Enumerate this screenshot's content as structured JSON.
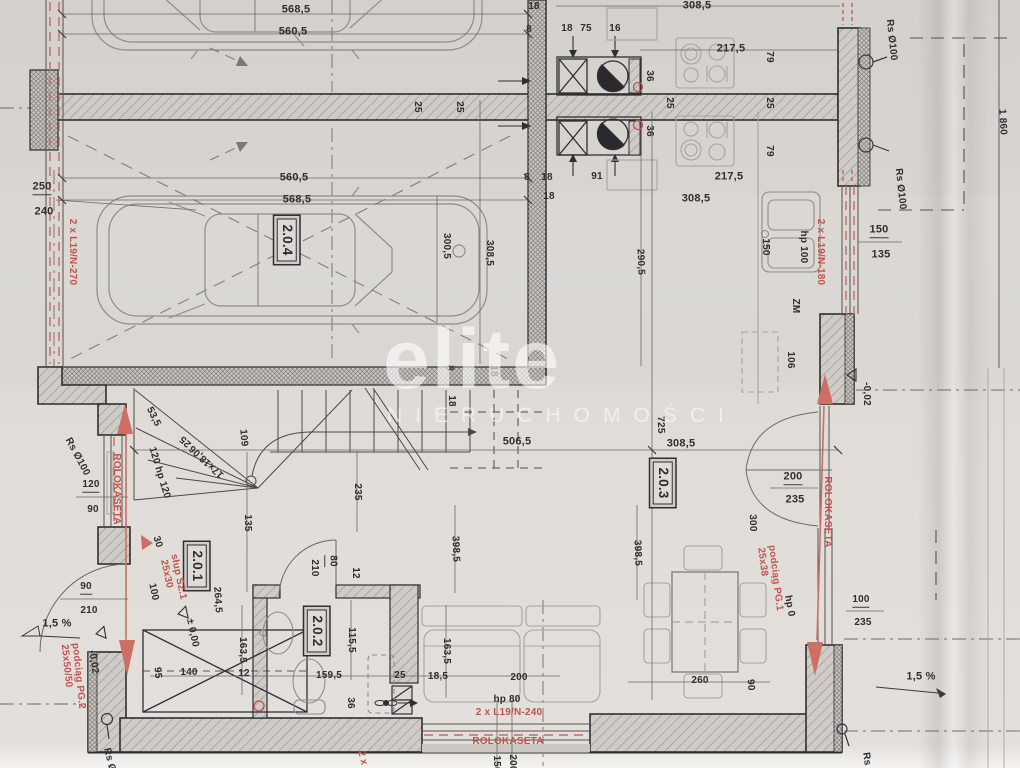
{
  "watermark": {
    "brand": "elite",
    "subtitle": "NIERUCHOMOŚCI"
  },
  "colors": {
    "paper": "#d9d6d2",
    "ink": "#3a393b",
    "light_gray": "#a9a7a3",
    "hatch": "#8e8c88",
    "red": "#bf544b",
    "salmon": "#cd6f62"
  },
  "rooms": [
    "2.0.1",
    "2.0.2",
    "2.0.3",
    "2.0.4"
  ],
  "labels": [
    {
      "t": "568,5",
      "x": 296,
      "y": 10,
      "c": "big"
    },
    {
      "t": "560,5",
      "x": 293,
      "y": 32,
      "c": "big"
    },
    {
      "t": "18",
      "x": 534,
      "y": 7
    },
    {
      "t": "8",
      "x": 529,
      "y": 30
    },
    {
      "t": "18",
      "x": 567,
      "y": 29
    },
    {
      "t": "75",
      "x": 586,
      "y": 29
    },
    {
      "t": "16",
      "x": 615,
      "y": 29
    },
    {
      "t": "308,5",
      "x": 697,
      "y": 6,
      "c": "big"
    },
    {
      "t": "217,5",
      "x": 731,
      "y": 49,
      "c": "big"
    },
    {
      "t": "79",
      "x": 769,
      "y": 57,
      "r": 90
    },
    {
      "t": "36",
      "x": 649,
      "y": 76,
      "r": 90
    },
    {
      "t": "25",
      "x": 417,
      "y": 107,
      "r": 90
    },
    {
      "t": "25",
      "x": 459,
      "y": 107,
      "r": 90
    },
    {
      "t": "25",
      "x": 669,
      "y": 103,
      "r": 90
    },
    {
      "t": "25",
      "x": 769,
      "y": 103,
      "r": 90
    },
    {
      "t": "36",
      "x": 649,
      "y": 131,
      "r": 90
    },
    {
      "t": "79",
      "x": 769,
      "y": 151,
      "r": 90
    },
    {
      "t": "8",
      "x": 527,
      "y": 178
    },
    {
      "t": "18",
      "x": 547,
      "y": 178
    },
    {
      "t": "91",
      "x": 597,
      "y": 177
    },
    {
      "t": "217,5",
      "x": 729,
      "y": 177,
      "c": "big"
    },
    {
      "t": "18",
      "x": 549,
      "y": 197
    },
    {
      "t": "308,5",
      "x": 696,
      "y": 199,
      "c": "big"
    },
    {
      "t": "560,5",
      "x": 294,
      "y": 178,
      "c": "big"
    },
    {
      "t": "568,5",
      "x": 297,
      "y": 200,
      "c": "big"
    },
    {
      "t": "250",
      "x": 42,
      "y": 188,
      "c": "ft big"
    },
    {
      "t": "240",
      "x": 44,
      "y": 212,
      "c": "big"
    },
    {
      "t": "2 x L19/N-270",
      "x": 72,
      "y": 252,
      "r": 90,
      "c": "red"
    },
    {
      "t": "Rs Ø100",
      "x": 891,
      "y": 40,
      "r": 84
    },
    {
      "t": "1 860",
      "x": 1002,
      "y": 122,
      "r": 87
    },
    {
      "t": "Rs Ø100",
      "x": 900,
      "y": 189,
      "r": 84
    },
    {
      "t": "150",
      "x": 879,
      "y": 231,
      "c": "ft big"
    },
    {
      "t": "135",
      "x": 881,
      "y": 255,
      "c": "big"
    },
    {
      "t": "2 x L19/N-180",
      "x": 820,
      "y": 252,
      "r": 90,
      "c": "red"
    },
    {
      "t": "hp 100",
      "x": 803,
      "y": 247,
      "r": 90
    },
    {
      "t": "150",
      "x": 765,
      "y": 247,
      "r": 90
    },
    {
      "t": "300,5",
      "x": 446,
      "y": 246,
      "r": 90
    },
    {
      "t": "308,5",
      "x": 489,
      "y": 253,
      "r": 90
    },
    {
      "t": "290,5",
      "x": 640,
      "y": 262,
      "r": 88
    },
    {
      "t": "2.0.4",
      "x": 287,
      "y": 240,
      "r": 90,
      "c": "room"
    },
    {
      "t": "ZM",
      "x": 795,
      "y": 306,
      "r": 90
    },
    {
      "t": "106",
      "x": 790,
      "y": 360,
      "r": 90
    },
    {
      "t": "-0,02",
      "x": 866,
      "y": 394,
      "r": 90
    },
    {
      "t": "8",
      "x": 449,
      "y": 368,
      "r": 90
    },
    {
      "t": "18",
      "x": 493,
      "y": 371,
      "r": 90
    },
    {
      "t": "18",
      "x": 451,
      "y": 401,
      "r": 90
    },
    {
      "t": "53,5",
      "x": 153,
      "y": 417,
      "r": 64
    },
    {
      "t": "25",
      "x": 186,
      "y": 441,
      "r": -137
    },
    {
      "t": "17x18,06",
      "x": 207,
      "y": 461,
      "r": -137
    },
    {
      "t": "109",
      "x": 243,
      "y": 438,
      "r": 85
    },
    {
      "t": "120 hp 120",
      "x": 159,
      "y": 473,
      "r": 73
    },
    {
      "t": "506,5",
      "x": 517,
      "y": 442,
      "c": "big"
    },
    {
      "t": "Rs Ø100",
      "x": 77,
      "y": 457,
      "r": 62
    },
    {
      "t": "ROLOKASETA",
      "x": 116,
      "y": 489,
      "r": 90,
      "c": "red"
    },
    {
      "t": "120",
      "x": 91,
      "y": 486,
      "c": "ft"
    },
    {
      "t": "90",
      "x": 93,
      "y": 510
    },
    {
      "t": "235",
      "x": 357,
      "y": 492,
      "r": 90
    },
    {
      "t": "135",
      "x": 247,
      "y": 523,
      "r": 90
    },
    {
      "t": "30",
      "x": 157,
      "y": 542,
      "r": 73
    },
    {
      "t": "725",
      "x": 660,
      "y": 425,
      "r": 88
    },
    {
      "t": "308,5",
      "x": 681,
      "y": 444,
      "c": "big"
    },
    {
      "t": "2.0.3",
      "x": 663,
      "y": 483,
      "r": 90,
      "c": "room"
    },
    {
      "t": "200",
      "x": 793,
      "y": 478,
      "c": "ft big"
    },
    {
      "t": "235",
      "x": 795,
      "y": 500,
      "c": "big"
    },
    {
      "t": "300",
      "x": 752,
      "y": 523,
      "r": 88
    },
    {
      "t": "ROLOKASETA",
      "x": 827,
      "y": 512,
      "r": 90,
      "c": "red"
    },
    {
      "t": "podciąg PG.1",
      "x": 775,
      "y": 578,
      "r": 83,
      "c": "red"
    },
    {
      "t": "25x38",
      "x": 762,
      "y": 562,
      "r": 83,
      "c": "red"
    },
    {
      "t": "1,5 %",
      "x": 57,
      "y": 624,
      "c": "big"
    },
    {
      "t": "90",
      "x": 86,
      "y": 588,
      "c": "ft"
    },
    {
      "t": "210",
      "x": 89,
      "y": 611
    },
    {
      "t": "2.0.1",
      "x": 197,
      "y": 566,
      "r": 90,
      "c": "room"
    },
    {
      "t": "słup SZ.1",
      "x": 178,
      "y": 577,
      "r": 78,
      "c": "red"
    },
    {
      "t": "25x30",
      "x": 166,
      "y": 574,
      "r": 78,
      "c": "red"
    },
    {
      "t": "100",
      "x": 153,
      "y": 592,
      "r": 78
    },
    {
      "t": "± 0,00",
      "x": 192,
      "y": 633,
      "r": 78
    },
    {
      "t": "264,5",
      "x": 217,
      "y": 600,
      "r": 86
    },
    {
      "t": "163,5",
      "x": 242,
      "y": 650,
      "r": 90
    },
    {
      "t": "95",
      "x": 157,
      "y": 673,
      "r": 85
    },
    {
      "t": "140",
      "x": 189,
      "y": 673
    },
    {
      "t": "12",
      "x": 244,
      "y": 674
    },
    {
      "t": "podciąg PG.2",
      "x": 78,
      "y": 676,
      "r": 84,
      "c": "red"
    },
    {
      "t": "25x50/50",
      "x": 66,
      "y": 666,
      "r": 84,
      "c": "red"
    },
    {
      "t": "-0,02",
      "x": 93,
      "y": 662,
      "r": 82
    },
    {
      "t": "80",
      "x": 331,
      "y": 561,
      "r": 90,
      "c": "ft"
    },
    {
      "t": "210",
      "x": 314,
      "y": 568,
      "r": 90
    },
    {
      "t": "12",
      "x": 355,
      "y": 573,
      "r": 90
    },
    {
      "t": "2.0.2",
      "x": 317,
      "y": 631,
      "r": 90,
      "c": "room"
    },
    {
      "t": "115,5",
      "x": 351,
      "y": 640,
      "r": 90
    },
    {
      "t": "159,5",
      "x": 329,
      "y": 676
    },
    {
      "t": "36",
      "x": 350,
      "y": 703,
      "r": 90
    },
    {
      "t": "163,5",
      "x": 446,
      "y": 651,
      "r": 90
    },
    {
      "t": "25",
      "x": 400,
      "y": 676
    },
    {
      "t": "18,5",
      "x": 438,
      "y": 677
    },
    {
      "t": "398,5",
      "x": 455,
      "y": 549,
      "r": 88
    },
    {
      "t": "398,5",
      "x": 637,
      "y": 553,
      "r": 88
    },
    {
      "t": "200",
      "x": 519,
      "y": 678
    },
    {
      "t": "hp 80",
      "x": 507,
      "y": 700
    },
    {
      "t": "2 x L19/N-240",
      "x": 509,
      "y": 713,
      "c": "red"
    },
    {
      "t": "ROLOKASETA",
      "x": 508,
      "y": 742,
      "c": "red"
    },
    {
      "t": "150",
      "x": 496,
      "y": 764,
      "r": 90
    },
    {
      "t": "200",
      "x": 512,
      "y": 763,
      "r": 90
    },
    {
      "t": "260",
      "x": 700,
      "y": 681
    },
    {
      "t": "90",
      "x": 750,
      "y": 685,
      "r": 86
    },
    {
      "t": "hp 0",
      "x": 789,
      "y": 606,
      "r": 80
    },
    {
      "t": "100",
      "x": 861,
      "y": 601,
      "c": "ft"
    },
    {
      "t": "235",
      "x": 863,
      "y": 623
    },
    {
      "t": "1,5 %",
      "x": 921,
      "y": 677,
      "c": "big"
    },
    {
      "t": "Rs Ø",
      "x": 109,
      "y": 760,
      "r": 76
    },
    {
      "t": "Rs",
      "x": 866,
      "y": 759,
      "r": 82
    },
    {
      "t": "2 x",
      "x": 362,
      "y": 758,
      "r": 76,
      "c": "red"
    }
  ]
}
